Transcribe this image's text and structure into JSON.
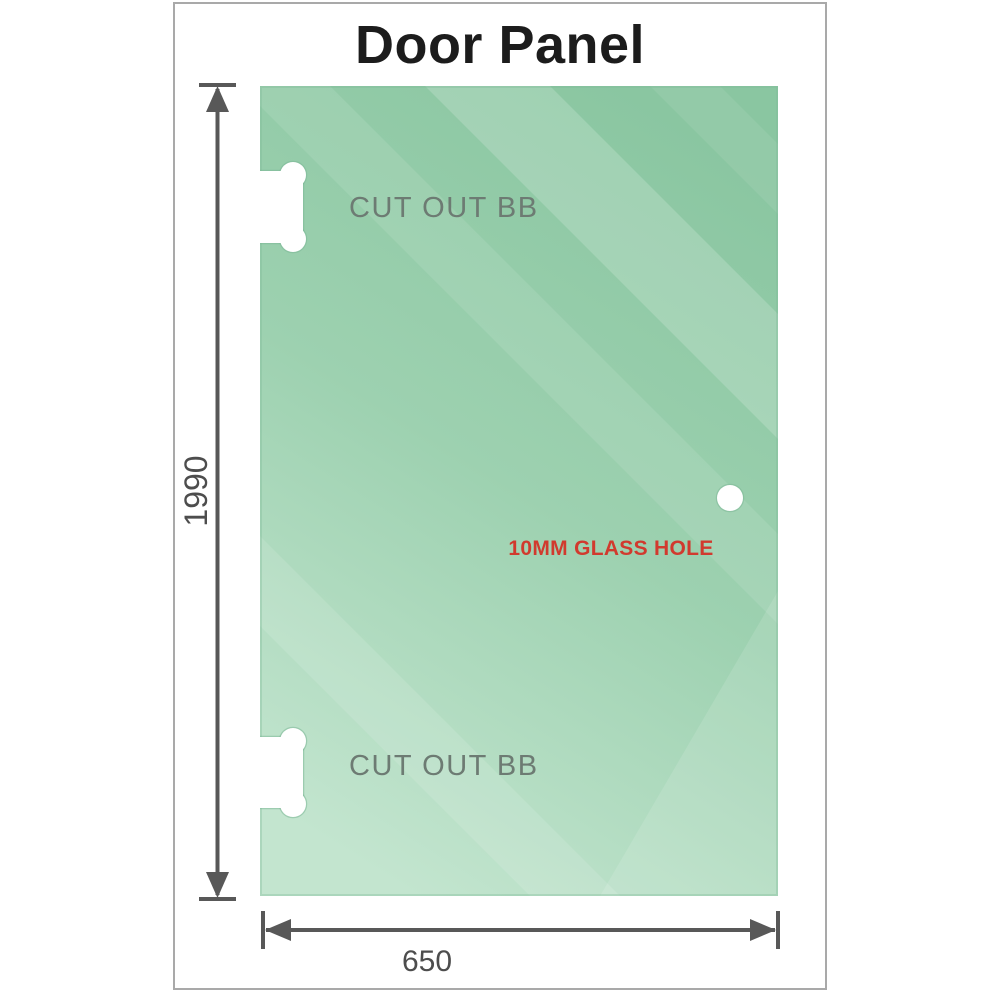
{
  "title": "Door Panel",
  "panel": {
    "cutout_label_top": "CUT OUT BB",
    "cutout_label_bottom": "CUT OUT BB",
    "glass_hole_label": "10MM GLASS HOLE"
  },
  "dimensions": {
    "height_label": "1990",
    "width_label": "650"
  },
  "colors": {
    "title_text": "#1c1c1c",
    "frame_border": "#a9a9a9",
    "glass_top": "#8ac6a1",
    "glass_mid": "#9dd1b0",
    "glass_bottom": "#c3e5cf",
    "stripe_highlight": "#ffffff",
    "panel_edge": "#7fba99",
    "cutout_fill": "#ffffff",
    "cutout_outline": "#7db898",
    "dimension_line": "#585858",
    "dimension_text": "#4d4d4d",
    "cutout_label_text": "#6d7b73",
    "hole_label_text": "#d13a2e"
  }
}
